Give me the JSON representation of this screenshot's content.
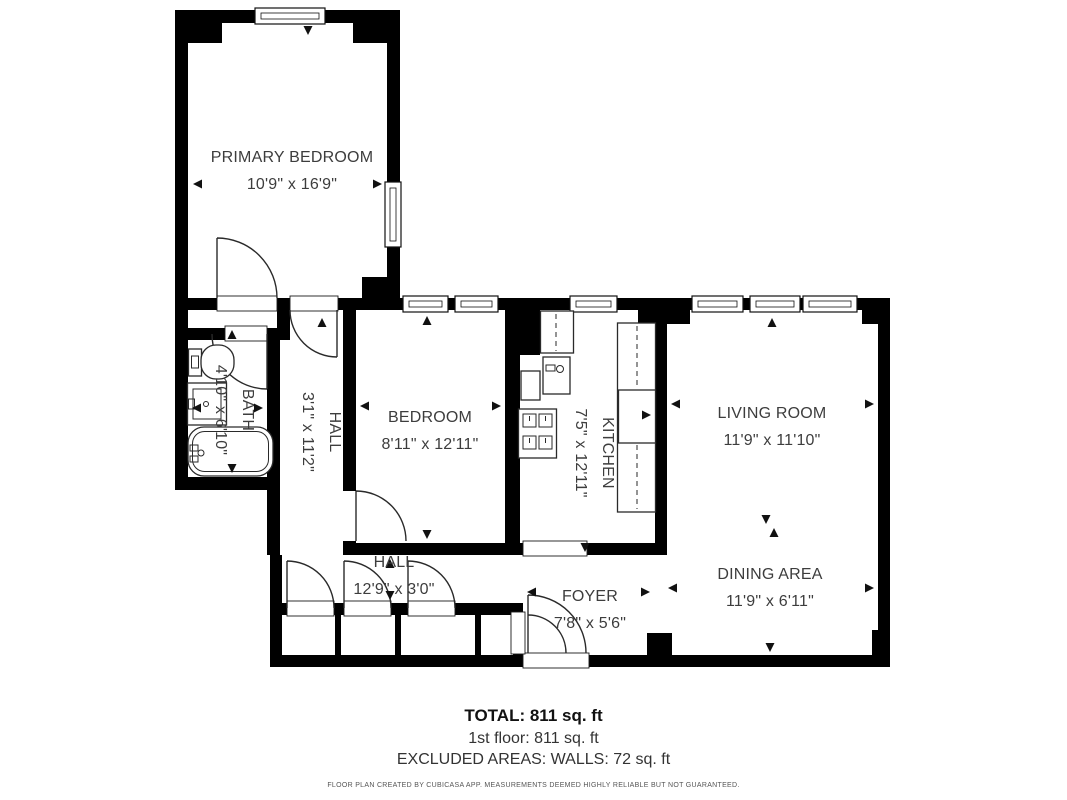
{
  "floor_plan": {
    "rooms": [
      {
        "id": "primary-bedroom",
        "name": "PRIMARY BEDROOM",
        "dims": "10'9\" x 16'9\""
      },
      {
        "id": "bath",
        "name": "BATH",
        "dims": "4'10\" x 6'10\""
      },
      {
        "id": "hall-vertical",
        "name": "HALL",
        "dims": "3'1\" x 11'2\""
      },
      {
        "id": "bedroom",
        "name": "BEDROOM",
        "dims": "8'11\" x 12'11\""
      },
      {
        "id": "kitchen",
        "name": "KITCHEN",
        "dims": "7'5\" x 12'11\""
      },
      {
        "id": "living-room",
        "name": "LIVING ROOM",
        "dims": "11'9\" x 11'10\""
      },
      {
        "id": "hall",
        "name": "HALL",
        "dims": "12'9\" x 3'0\""
      },
      {
        "id": "foyer",
        "name": "FOYER",
        "dims": "7'8\" x 5'6\""
      },
      {
        "id": "dining-area",
        "name": "DINING AREA",
        "dims": "11'9\" x 6'11\""
      }
    ],
    "summary": {
      "total": "TOTAL: 811 sq. ft",
      "first_floor": "1st floor: 811 sq. ft",
      "excluded": "EXCLUDED AREAS: WALLS: 72 sq. ft"
    },
    "disclaimer": "FLOOR PLAN CREATED BY CUBICASA APP. MEASUREMENTS DEEMED HIGHLY RELIABLE BUT NOT GUARANTEED.",
    "colors": {
      "wall": "#000000",
      "label": "#3d3d3d",
      "background": "#ffffff"
    }
  }
}
